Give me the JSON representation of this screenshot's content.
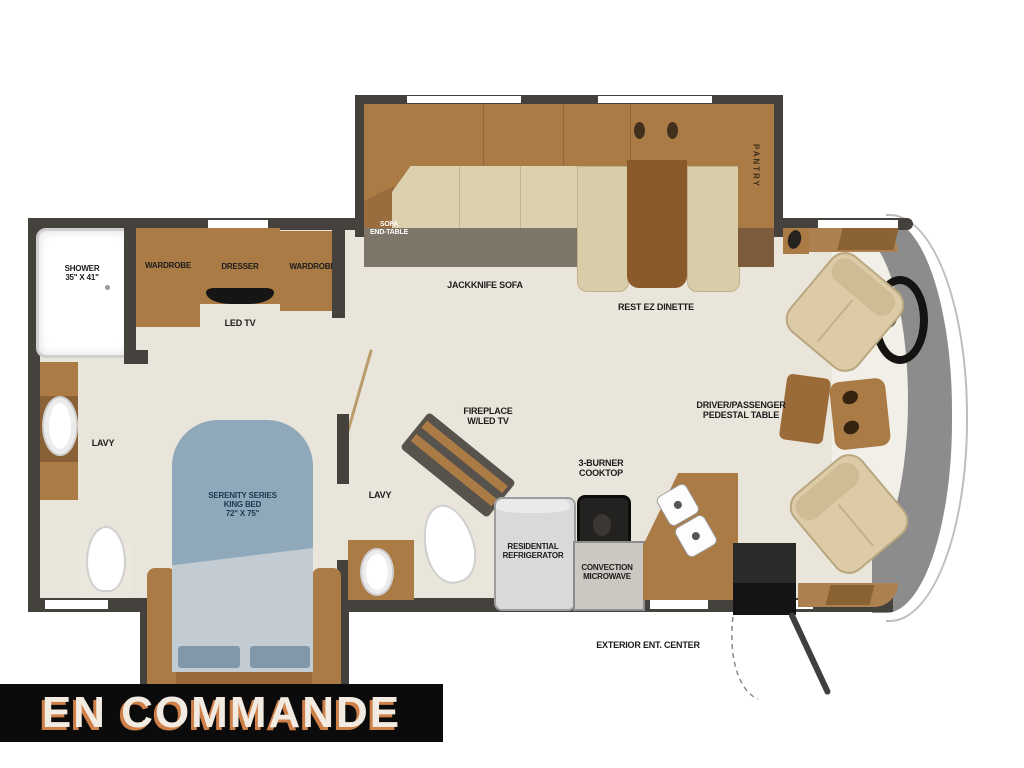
{
  "banner": {
    "text": "EN COMMANDE"
  },
  "labels": {
    "shower": [
      "SHOWER",
      "35\" X 41\""
    ],
    "wardrobe_left": "WARDROBE",
    "dresser": "DRESSER",
    "wardrobe_right": "WARDROBE",
    "led_tv": "LED TV",
    "lavy_rear": "LAVY",
    "lavy_mid": "LAVY",
    "sofa_end_table": [
      "SOFA",
      "END-TABLE"
    ],
    "jackknife_sofa": "JACKKNIFE SOFA",
    "rest_ez_dinette": "REST EZ DINETTE",
    "pantry": "PANTRY",
    "king_bed": [
      "SERENITY SERIES",
      "KING BED",
      "72\" X 75\""
    ],
    "fireplace": [
      "FIREPLACE",
      "W/LED TV"
    ],
    "refrigerator": [
      "RESIDENTIAL",
      "REFRIGERATOR"
    ],
    "cooktop": [
      "3-BURNER",
      "COOKTOP"
    ],
    "microwave": [
      "CONVECTION",
      "MICROWAVE"
    ],
    "pedestal_table": [
      "DRIVER/PASSENGER",
      "PEDESTAL TABLE"
    ],
    "exterior_ent_center": "EXTERIOR ENT. CENTER"
  },
  "colors": {
    "wall": "#45413d",
    "floor": "#eae5db",
    "cabinet": "#ab7b46",
    "cabinet_dark": "#8a6136",
    "table": "#8a5a2b",
    "sofa": "#ddd0ae",
    "slide_floor": "#7d7568",
    "bed": "#8fa9bb",
    "bed_foot": "#c3ccd3",
    "cab": "#8c8c8c",
    "banner_bg": "#0b0b0b",
    "banner_text": "#f2ebe2",
    "banner_shadow": "#cf8049"
  }
}
